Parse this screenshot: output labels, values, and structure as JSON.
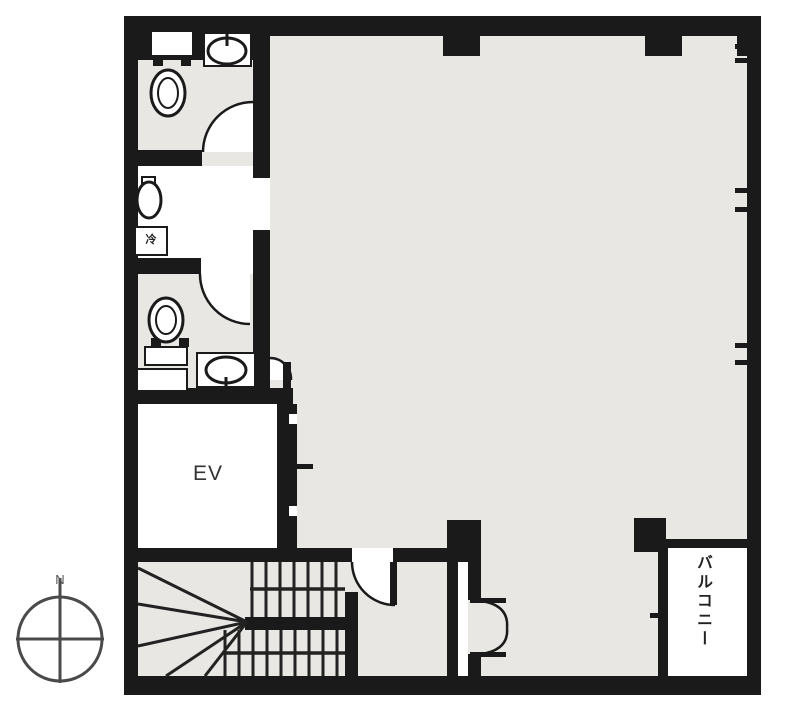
{
  "page": {
    "type": "architectural-floor-plan",
    "title": "building floor plan"
  },
  "labels": {
    "elevator": "EV",
    "balcony": "バルコニー",
    "refrigerator": "冷",
    "compass_north": "N"
  },
  "colors": {
    "wall": "#1a1a1a",
    "floor": "#e8e7e4",
    "fixture_white": "#ffffff",
    "background": "#ffffff",
    "compass": "#4a4a4a",
    "label_text": "#333333"
  },
  "icons": [
    "toilet-icon",
    "sink-icon",
    "urinal-icon",
    "refrigerator-icon",
    "door-swing-icon",
    "double-door-icon",
    "elevator-door-icon",
    "stairs-icon",
    "window-tick-icon",
    "column-icon",
    "compass-icon"
  ]
}
